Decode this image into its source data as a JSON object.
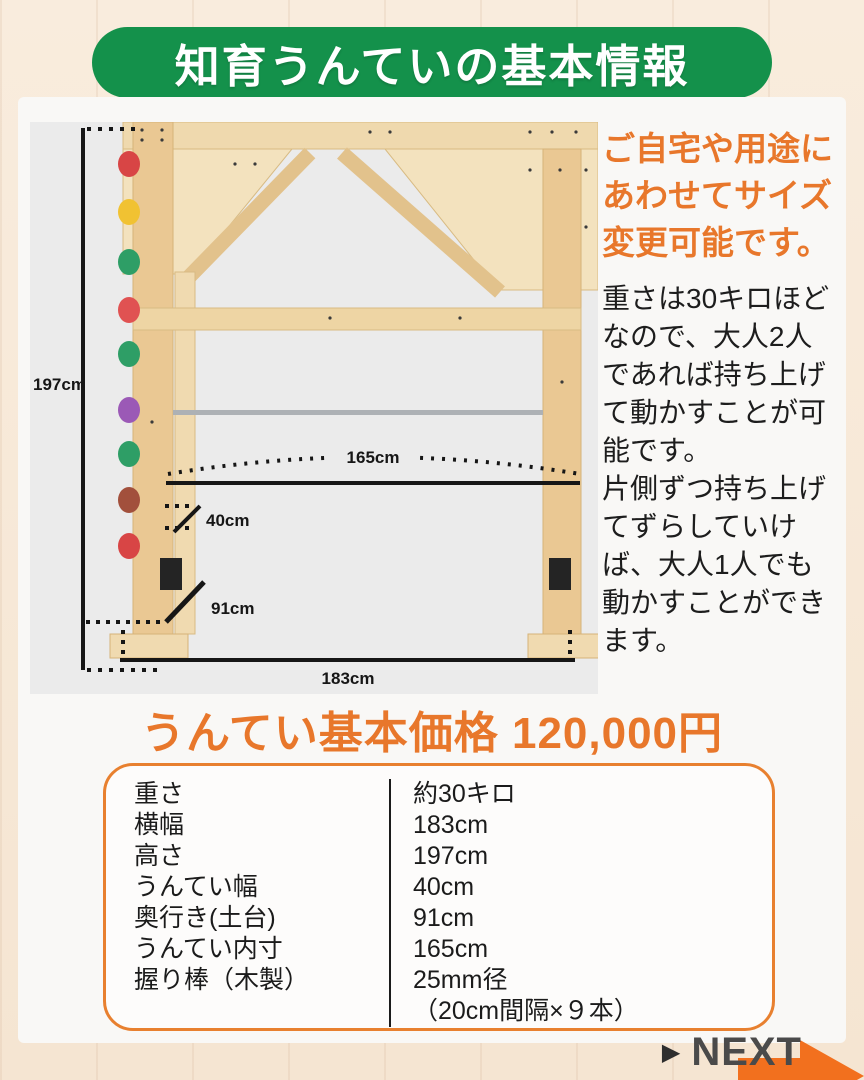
{
  "header": {
    "title": "知育うんていの基本情報"
  },
  "diagram": {
    "height": "197cm",
    "inner_width": "165cm",
    "untei_width": "40cm",
    "base_depth": "91cm",
    "total_width": "183cm"
  },
  "info": {
    "highlight_lines": [
      "ご自宅や用途に",
      "あわせてサイズ",
      "変更可能です。"
    ],
    "body_lines": [
      "重さは30キロほど",
      "なので、大人2人",
      "であれば持ち上げ",
      "て動かすことが可",
      "能です。",
      "片側ずつ持ち上げ",
      "てずらしていけ",
      "ば、大人1人でも",
      "動かすことができ",
      "ます。"
    ]
  },
  "price": {
    "heading": "うんてい基本価格 120,000円"
  },
  "spec_table": {
    "rows": [
      {
        "label": "重さ",
        "value": "約30キロ"
      },
      {
        "label": "横幅",
        "value": "183cm"
      },
      {
        "label": "高さ",
        "value": "197cm"
      },
      {
        "label": "うんてい幅",
        "value": "40cm"
      },
      {
        "label": "奥行き(土台)",
        "value": "91cm"
      },
      {
        "label": "うんてい内寸",
        "value": "165cm"
      },
      {
        "label": "握り棒（木製）",
        "value": "25mm径",
        "value2": "（20cm間隔×９本）"
      }
    ]
  },
  "next": {
    "pointer": "▶",
    "label": "NEXT"
  },
  "colors": {
    "banner_green": "#14914B",
    "accent_orange": "#E8772B",
    "table_border_orange": "#E8802F",
    "arrow_orange": "#F2701E",
    "background_cream": "#F7E8D8",
    "diagram_gray": "#EBEBEB"
  }
}
